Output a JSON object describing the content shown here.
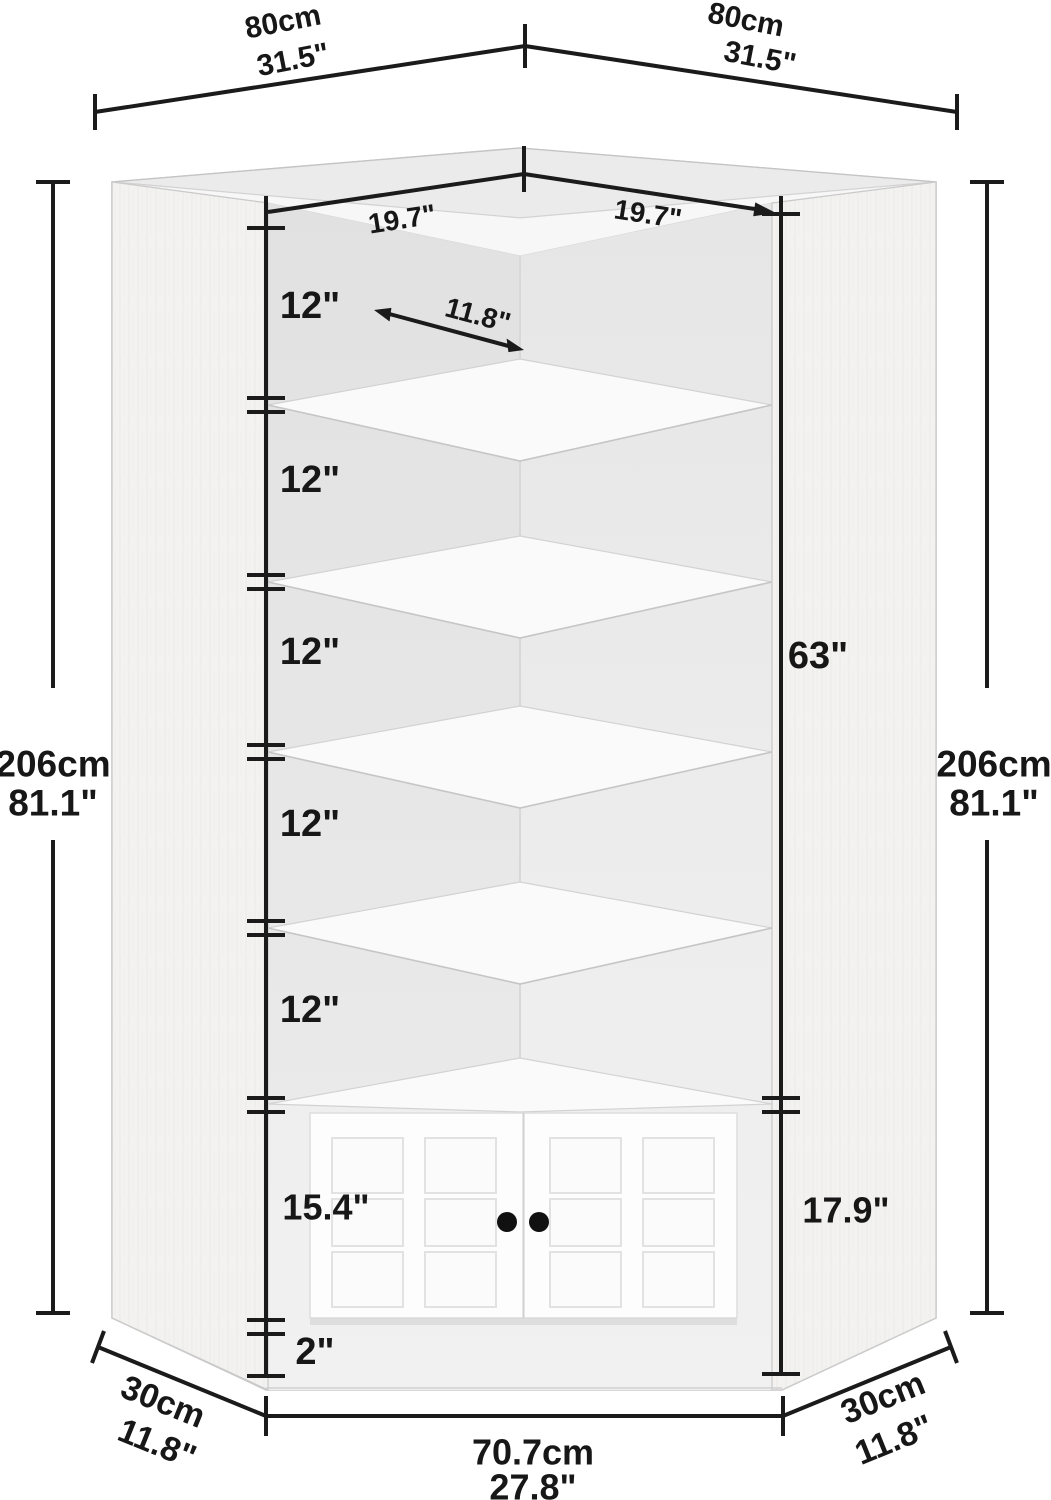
{
  "figure": {
    "type": "product-dimension-diagram",
    "subject": "corner storage cabinet with 6 tiers and double doors",
    "colors": {
      "dimension_line": "#1b1b1b",
      "cabinet_face": "#f4f3f2",
      "cabinet_top": "#ebebeb",
      "interior_back": "#e9e9e9",
      "shelf": "#fafafa",
      "door": "#fdfdfd",
      "knob": "#111111"
    },
    "top_width_left": {
      "cm": "80cm",
      "in": "31.5\""
    },
    "top_width_right": {
      "cm": "80cm",
      "in": "31.5\""
    },
    "inner_width_left": "19.7\"",
    "inner_width_right": "19.7\"",
    "shelf_depth_arrow": "11.8\"",
    "shelf_heights": [
      "12\"",
      "12\"",
      "12\"",
      "12\"",
      "12\""
    ],
    "interior_height": "63\"",
    "total_height_left": {
      "cm": "206cm",
      "in": "81.1\""
    },
    "total_height_right": {
      "cm": "206cm",
      "in": "81.1\""
    },
    "cabinet_height_left": "15.4\"",
    "cabinet_height_right": "17.9\"",
    "base_height": "2\"",
    "side_depth_left": {
      "cm": "30cm",
      "in": "11.8\""
    },
    "side_depth_right": {
      "cm": "30cm",
      "in": "11.8\""
    },
    "front_bottom_width": {
      "cm": "70.7cm",
      "in": "27.8\""
    }
  }
}
